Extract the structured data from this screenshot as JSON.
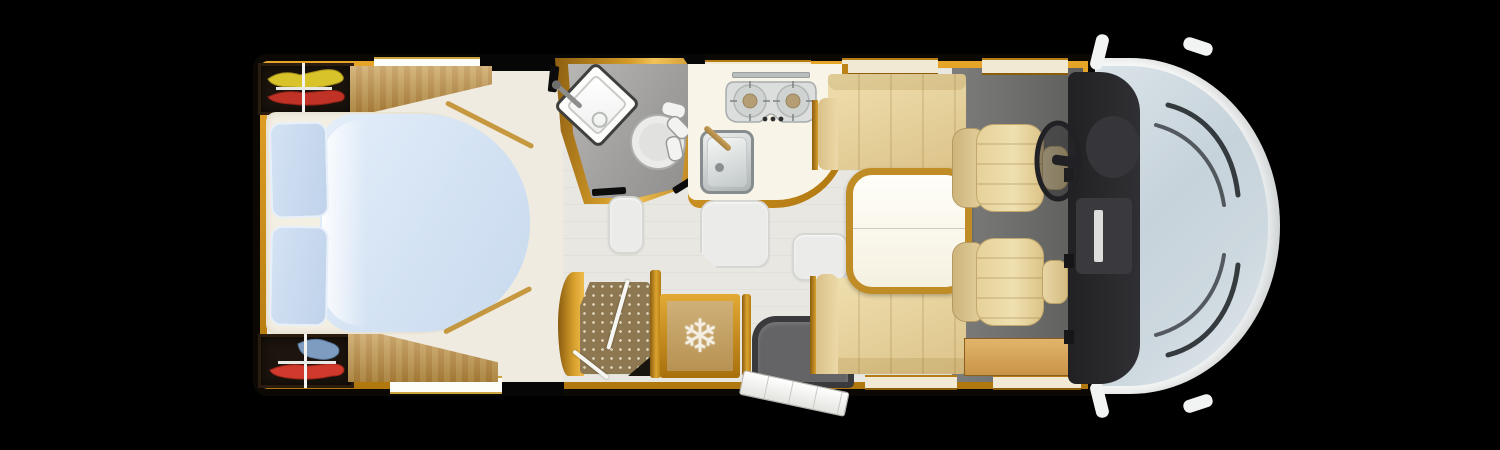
{
  "scene": {
    "type": "motorhome-floorplan-top-view",
    "background": "#000000"
  },
  "colors": {
    "background": "#000000",
    "amber_trim": "#c8881a",
    "wood": "#b8883c",
    "floor_living": "#e9e7e2",
    "floor_bathroom": "#9e9d9b",
    "floor_cab": "#6e6e6c",
    "upholstery_beige": "#e6d199",
    "bed_duvet_blue": "#d3e2f3",
    "mattress_cream": "#f3efe3",
    "shower_tray_brown": "#8e7852",
    "fridge_tan": "#c0a068",
    "dashboard_dark": "#2a2a2c",
    "windshield_blue": "#cdd8df",
    "body_white": "#f5f6f6",
    "cloth_yellow": "#d9c32a",
    "cloth_red": "#c03226",
    "cloth_blue": "#7d9cc0"
  },
  "icons": {
    "fridge_snowflake": "❄"
  },
  "labels": {
    "vehicle": "motorhome floor plan – top view",
    "cab": "driver cab",
    "windshield": "windscreen with wipers",
    "dashboard": "dashboard",
    "steering_wheel": "steering wheel",
    "driver_seat": "swivel captain seat",
    "passenger_seat": "swivel captain seat",
    "mirror": "side mirror",
    "bed": "island bed with duvet",
    "pillow": "pillow",
    "wardrobe": "wardrobe with hanging clothes",
    "bathroom": "washroom",
    "washbasin": "corner washbasin",
    "toilet": "toilet",
    "kitchen": "kitchen block",
    "hob": "two-burner hob",
    "kitchen_sink": "kitchen sink",
    "shower": "shower cubicle",
    "fridge": "refrigerator",
    "entry": "entrance door (open)",
    "door_mat": "entrance step mat",
    "sofa": "dinette sofa",
    "bench": "dinette bench",
    "table": "dinette table",
    "sideboard": "side board",
    "hatch": "floor storage hatch",
    "window": "window",
    "wood_cabinet": "bed surround cabinet"
  }
}
